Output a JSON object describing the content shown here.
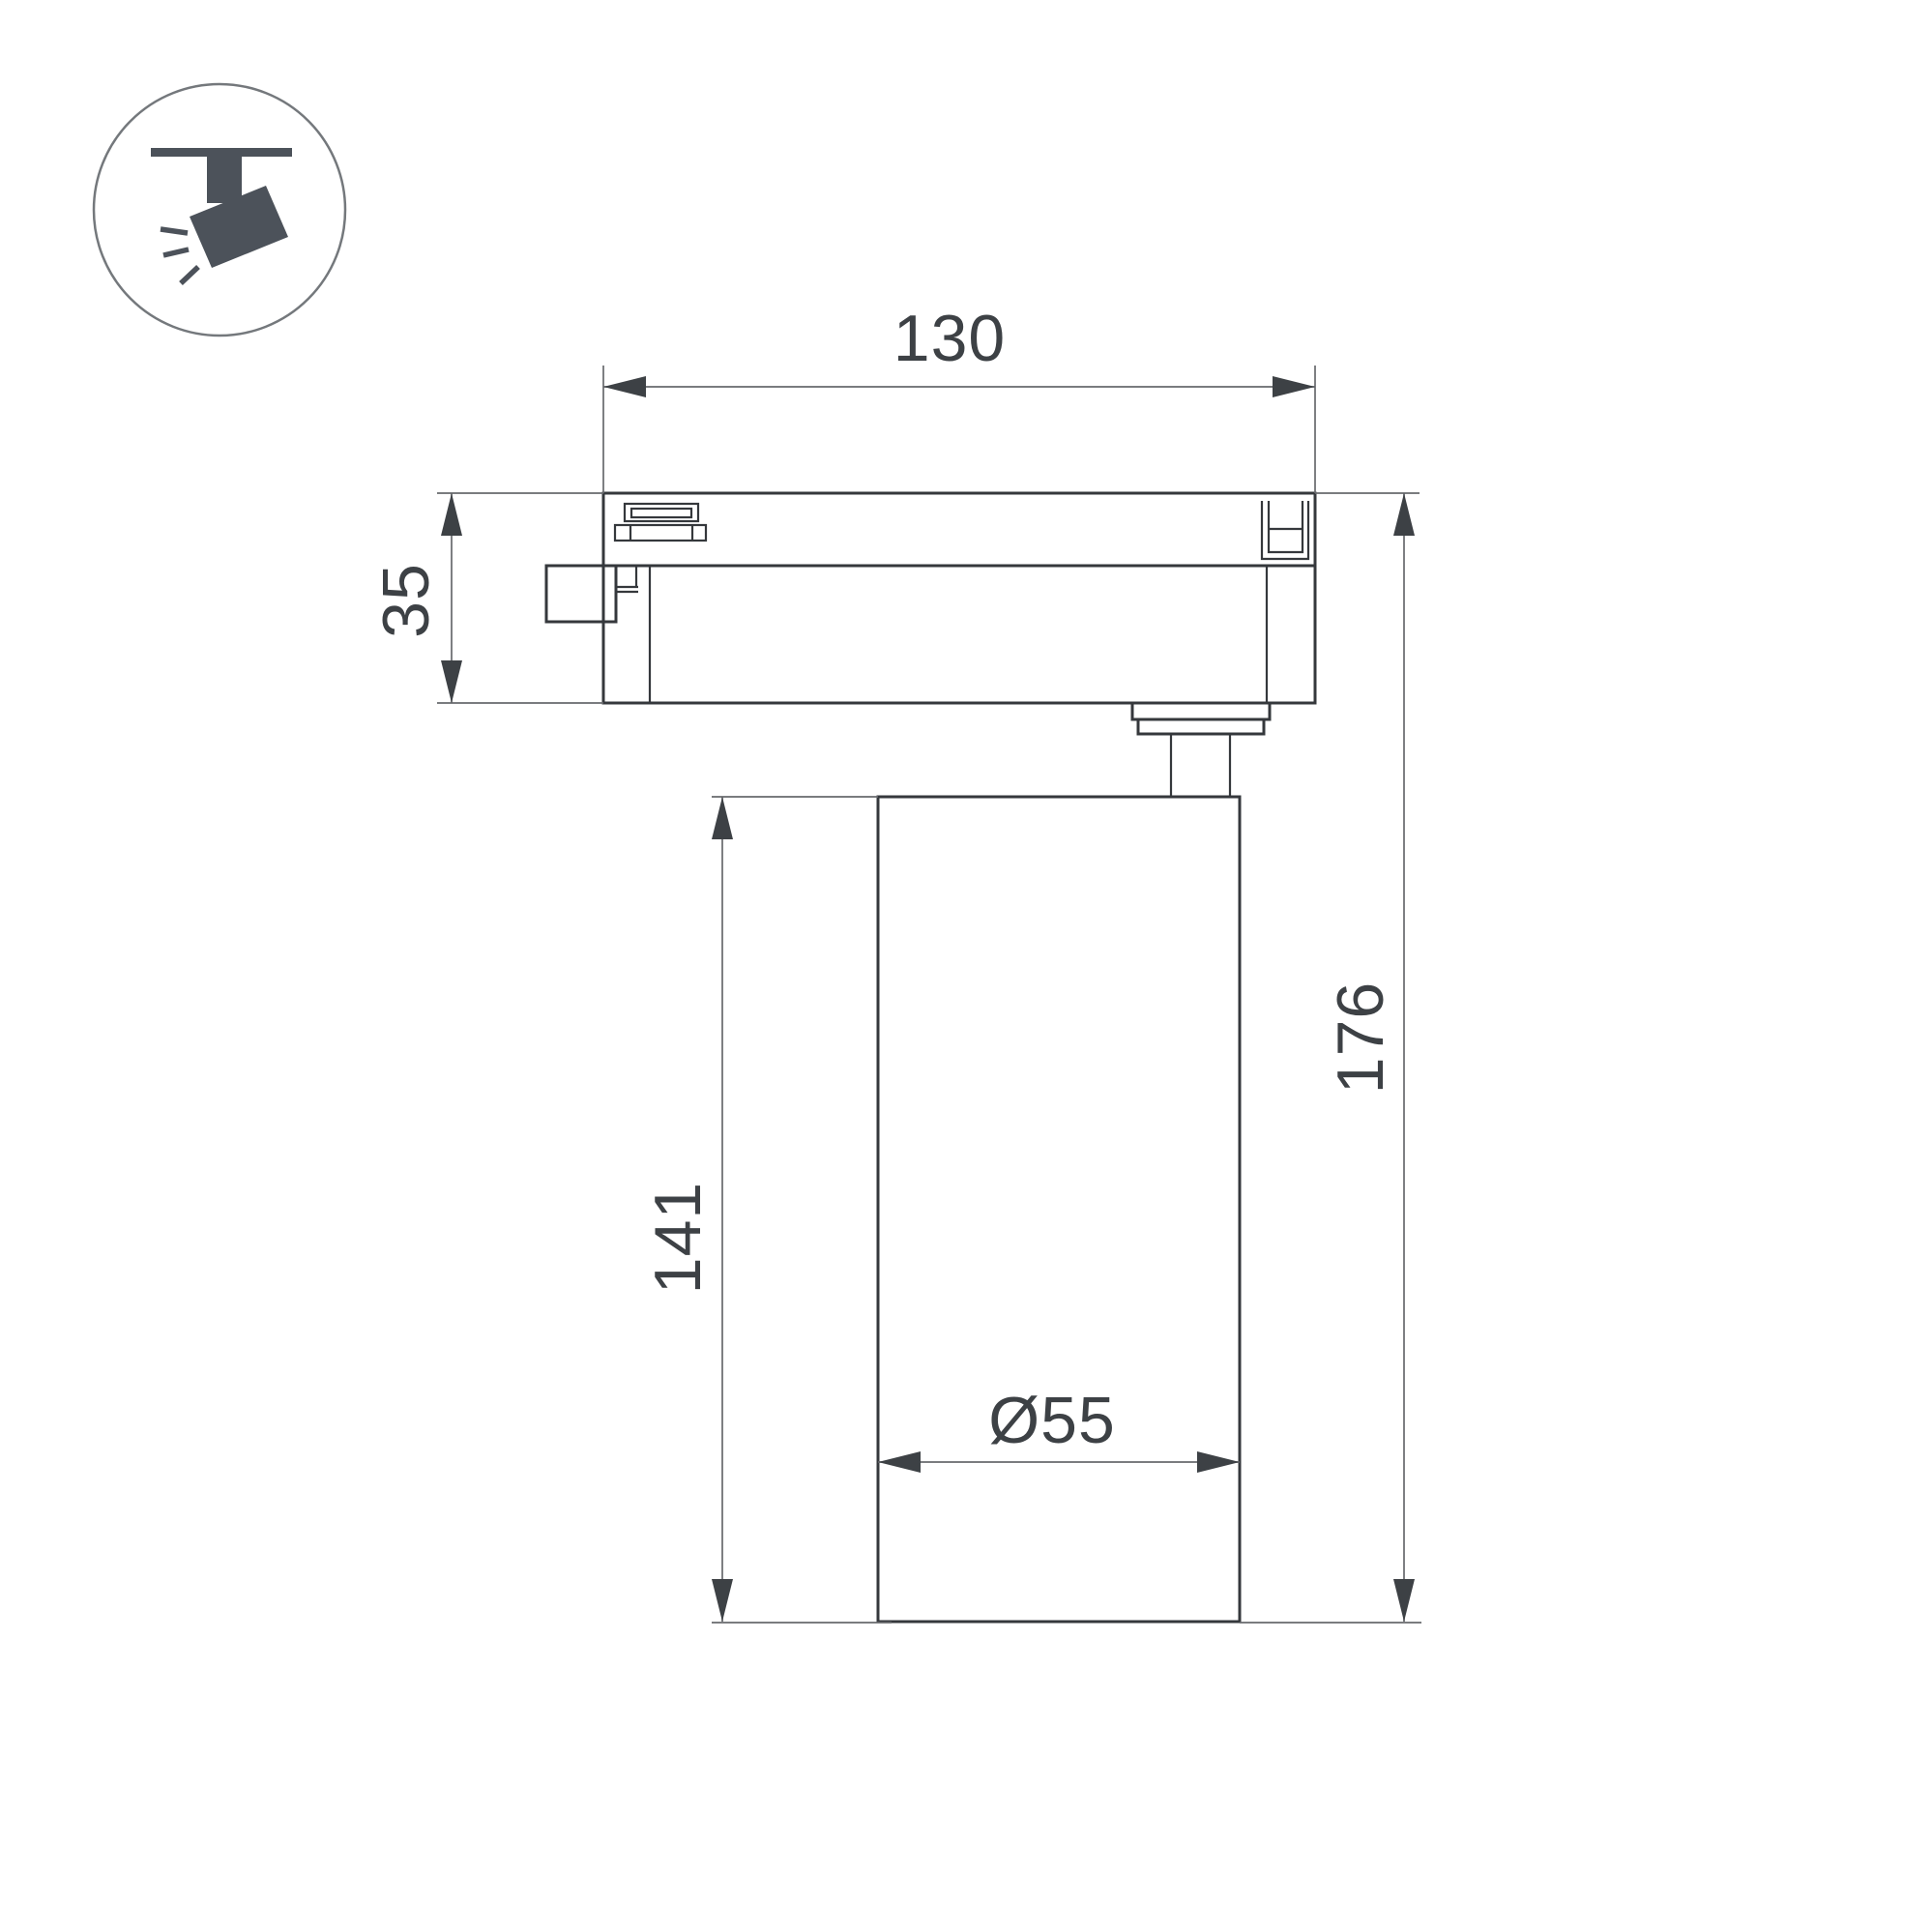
{
  "colors": {
    "background": "#ffffff",
    "outline": "#35383c",
    "thin_line": "#67696d",
    "arrow_and_text": "#3d4145",
    "icon_fill": "#4c525a",
    "icon_circle_stroke": "#74787c"
  },
  "legend_icon": {
    "name": "track-mounted-spotlight"
  },
  "dimensions": {
    "adapter_width": "130",
    "adapter_height": "35",
    "body_height": "141",
    "total_height": "176",
    "body_diameter": "Ø55"
  }
}
